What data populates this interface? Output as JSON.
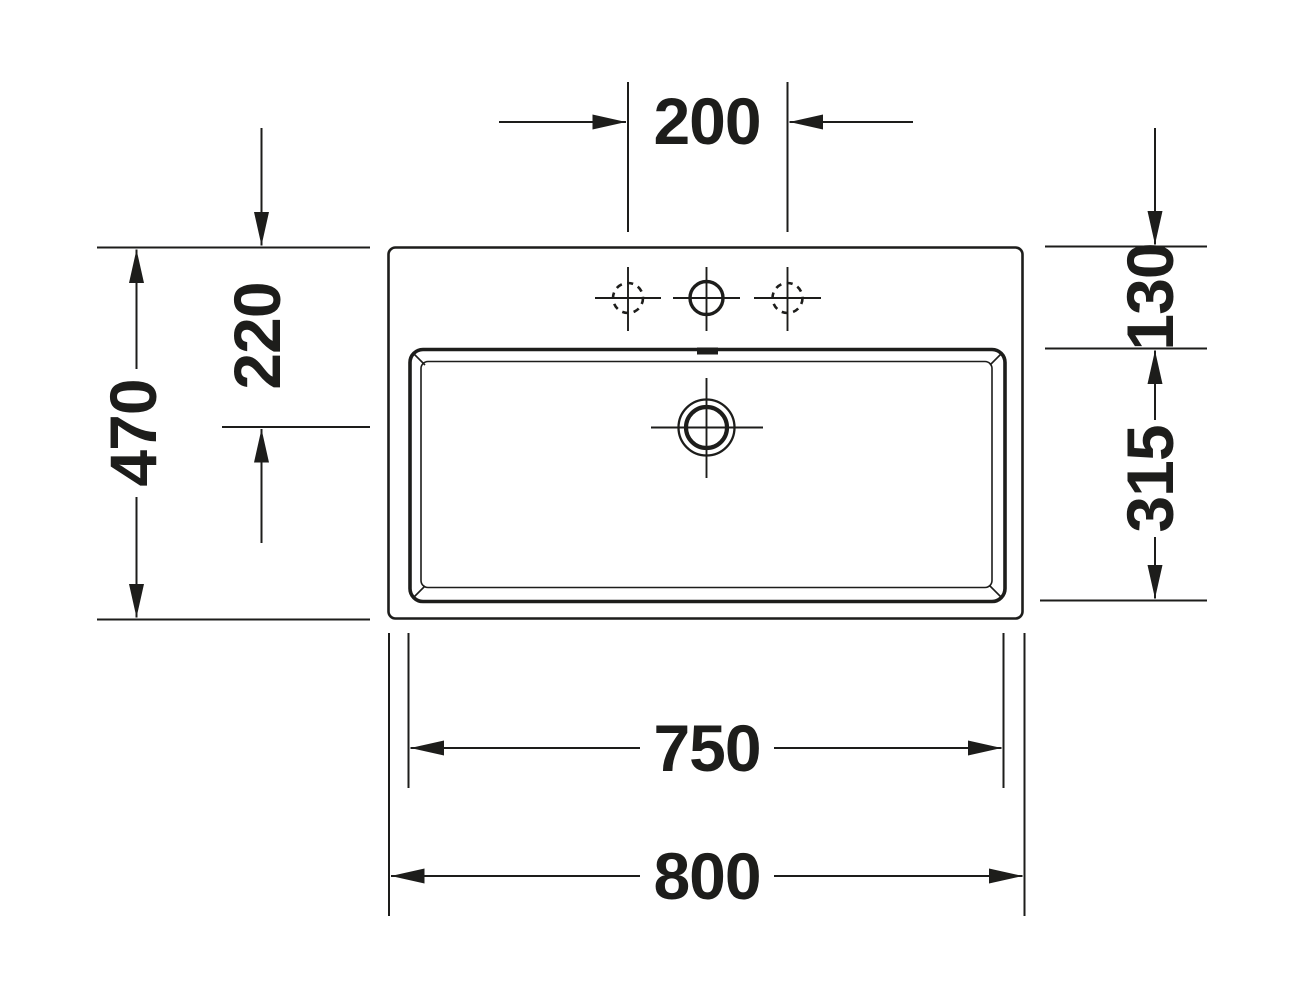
{
  "diagram": {
    "kind": "washbasin-top-view-technical-drawing",
    "dims": {
      "tap_hole_spacing": "200",
      "overall_depth": "470",
      "drain_center_from_back": "220",
      "back_edge_to_basin": "130",
      "basin_inner_depth": "315",
      "basin_outer_width": "750",
      "overall_width": "800"
    },
    "colors": {
      "line": "#1d1d1b",
      "background": "#ffffff"
    }
  }
}
